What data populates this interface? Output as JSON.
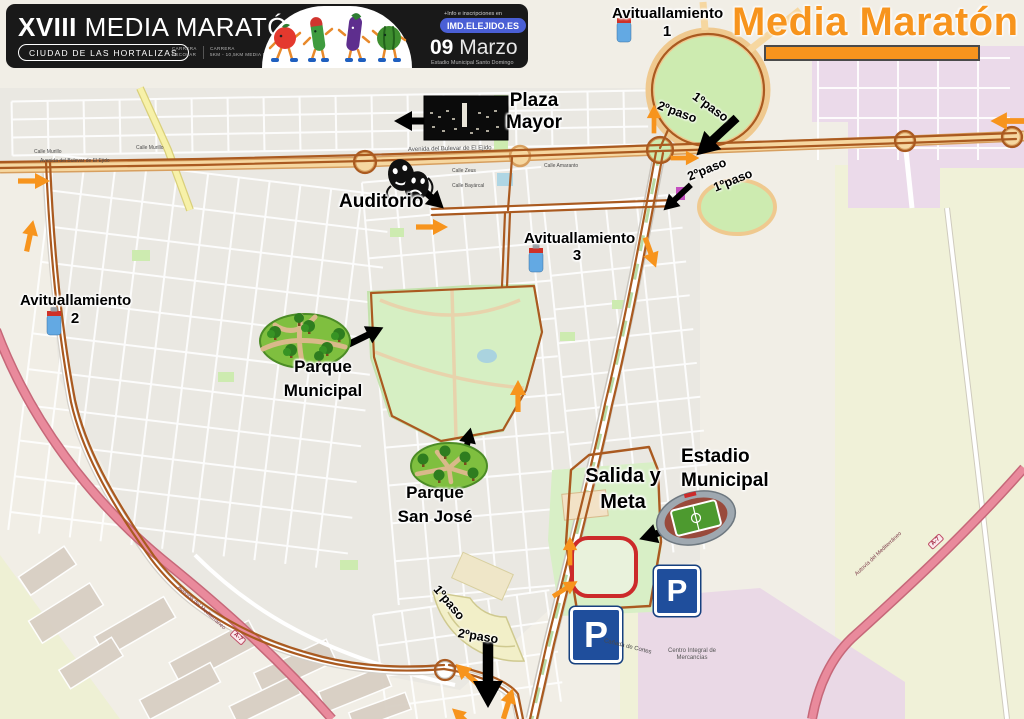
{
  "banner": {
    "edition": "XVIII",
    "title": "MEDIA MARATÓN",
    "tagline": "CIUDAD DE LAS HORTALIZAS",
    "race_categories": [
      {
        "line1": "CARRERA",
        "line2": "ESCOLAR"
      },
      {
        "line1": "CARRERA",
        "line2": "5KM - 10,5KM MEDIA MARATÓN"
      }
    ],
    "info_label": "+Info e inscripciones en",
    "info_site": "IMD.ELEJIDO.ES",
    "date_day": "09",
    "date_month": "Marzo",
    "venue": "Estadio Municipal Santo Domingo",
    "mascots": "running-vegetables"
  },
  "map_title": {
    "text": "Media Maratón",
    "color": "#F7941D"
  },
  "aid_stations": [
    {
      "label": "Avituallamiento",
      "number": "1"
    },
    {
      "label": "Avituallamiento",
      "number": "2"
    },
    {
      "label": "Avituallamiento",
      "number": "3"
    }
  ],
  "landmarks": {
    "plaza_mayor": {
      "line1": "Plaza",
      "line2": "Mayor"
    },
    "auditorio": {
      "line1": "Auditorio"
    },
    "parque_municipal": {
      "line1": "Parque",
      "line2": "Municipal"
    },
    "parque_san_jose": {
      "line1": "Parque",
      "line2": "San José"
    },
    "salida_meta": {
      "line1": "Salida y",
      "line2": "Meta"
    },
    "estadio_municipal": {
      "line1": "Estadio",
      "line2": "Municipal"
    }
  },
  "route_markers": {
    "paso1": "1ºpaso",
    "paso2": "2ºpaso"
  },
  "parking_label": "P",
  "streets": {
    "bulevar": "Avenida del Bulevar de El Ejido",
    "infanta_cristina": "Avenida de la Infanta Cristina",
    "canada_cortes": "Cañada de Cortes",
    "centro_mercancias": "Centro Integral de Mercancías",
    "autovia": "Autovía del Mediterráneo",
    "avenida_mediterraneo": "Avenida del Mediterráneo",
    "a7": "A-7",
    "murillo": "Calle Murillo",
    "zeus": "Calle Zeus",
    "bayarcal": "Calle Bayárcal",
    "amaranto": "Calle Amaranto"
  },
  "colors": {
    "route": "#AA5A20",
    "direction_arrow": "#F7941D",
    "annotation_arrow": "#000000",
    "park_green": "#CDEBB0",
    "boulevard_tan": "#F6D7A0",
    "motorway_pink": "#E98A9C",
    "industrial_pink": "#EBDAEA",
    "parking_blue": "#1F4E9C",
    "title_orange": "#F7941D",
    "banner_black": "#191919"
  }
}
